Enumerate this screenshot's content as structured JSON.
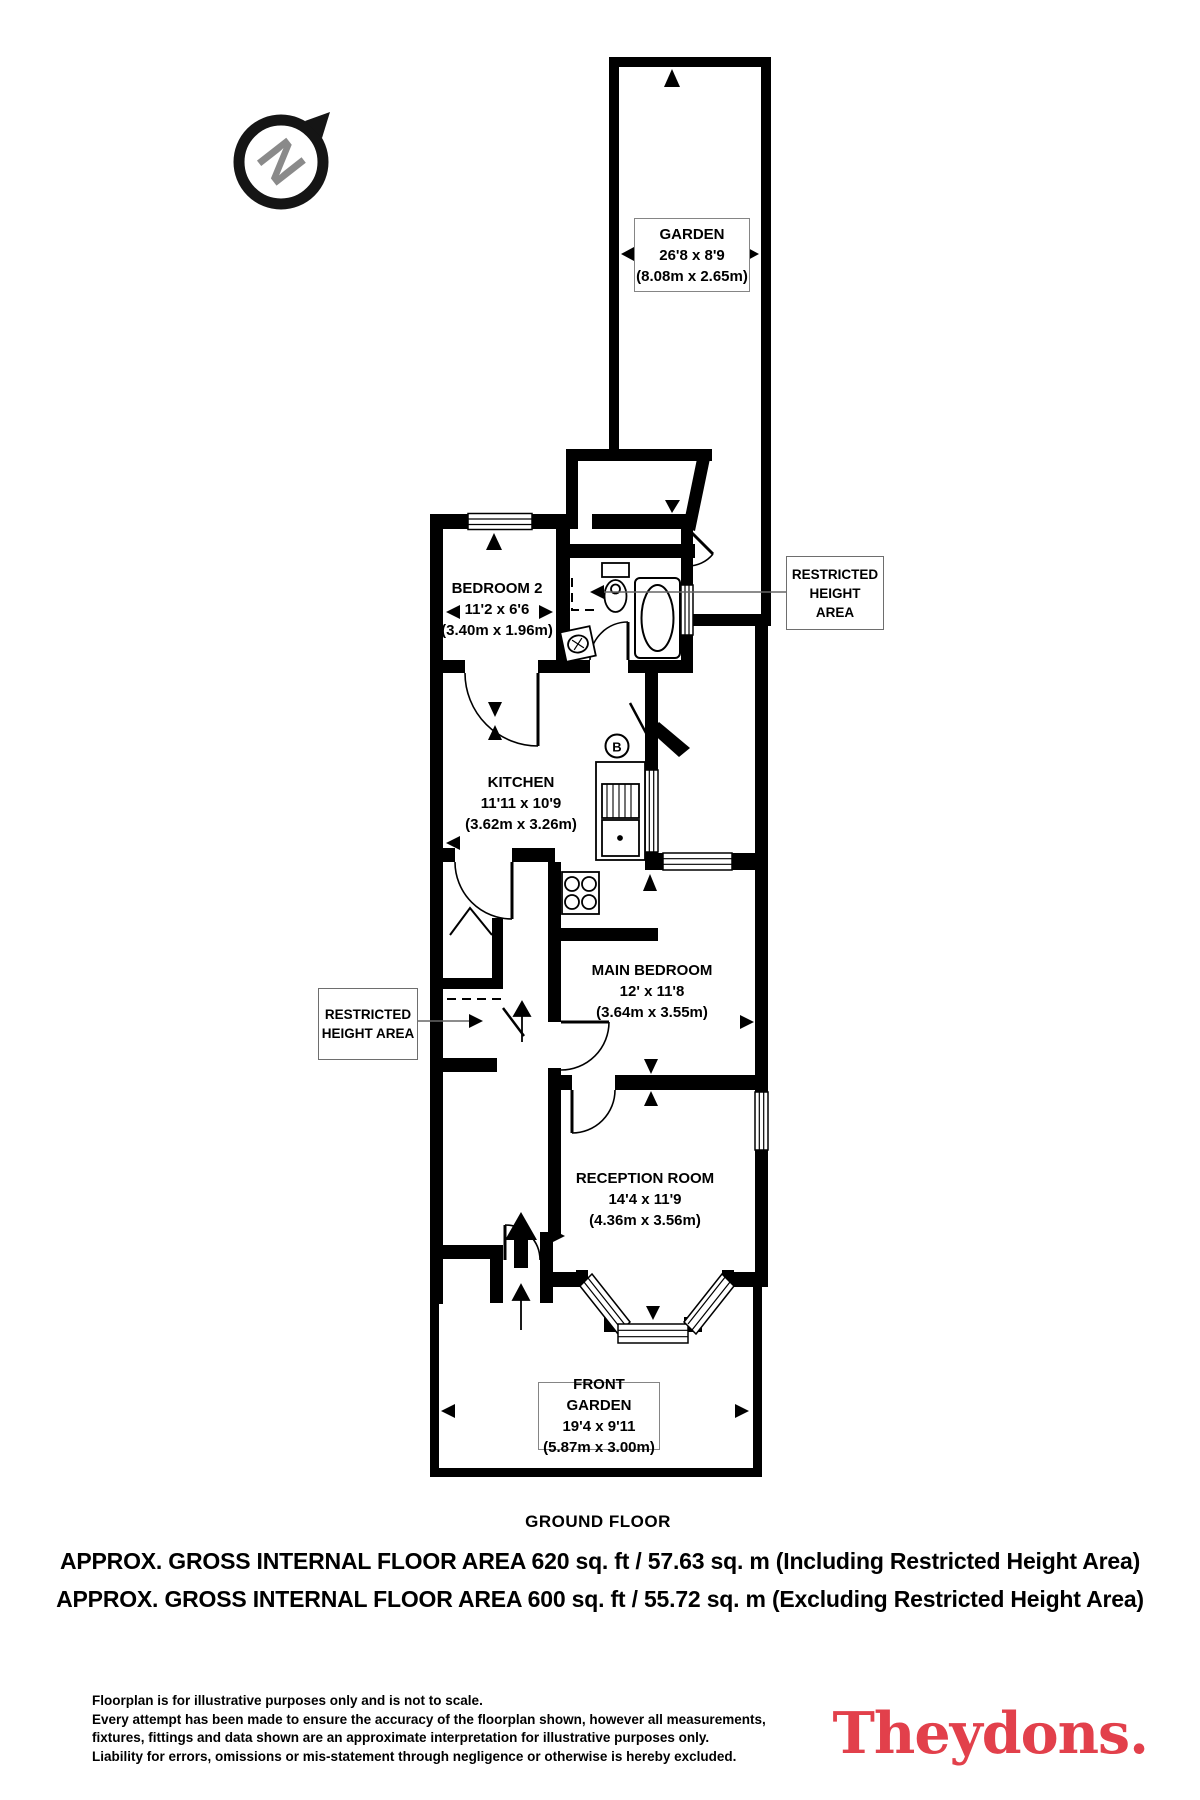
{
  "compass": {
    "letter": "N"
  },
  "plan": {
    "rooms": {
      "garden": {
        "name": "GARDEN",
        "dims": "26'8 x 8'9",
        "metric": "(8.08m x 2.65m)"
      },
      "bedroom2": {
        "name": "BEDROOM 2",
        "dims": "11'2 x 6'6",
        "metric": "(3.40m x 1.96m)"
      },
      "kitchen": {
        "name": "KITCHEN",
        "dims": "11'11 x 10'9",
        "metric": "(3.62m x 3.26m)"
      },
      "main_bedroom": {
        "name": "MAIN BEDROOM",
        "dims": "12' x 11'8",
        "metric": "(3.64m x 3.55m)"
      },
      "reception": {
        "name": "RECEPTION ROOM",
        "dims": "14'4 x 11'9",
        "metric": "(4.36m x 3.56m)"
      },
      "front_garden": {
        "name": "FRONT GARDEN",
        "dims": "19'4 x 9'11",
        "metric": "(5.87m x 3.00m)"
      }
    },
    "restricted_height_label": "RESTRICTED HEIGHT AREA",
    "boiler_letter": "B",
    "floor_title": "GROUND FLOOR"
  },
  "footer": {
    "area_line_1": "APPROX. GROSS INTERNAL FLOOR AREA 620 sq. ft / 57.63 sq. m (Including Restricted Height Area)",
    "area_line_2": "APPROX. GROSS INTERNAL FLOOR AREA 600 sq. ft / 55.72 sq. m (Excluding Restricted Height Area)",
    "disclaimer_lines": [
      "Floorplan is for illustrative purposes only and is not to scale.",
      "Every attempt has been made to ensure the accuracy of the floorplan shown, however all measurements,",
      "fixtures, fittings and data shown are an approximate interpretation for illustrative purposes only.",
      "Liability for errors, omissions or mis-statement through negligence or otherwise is hereby excluded."
    ],
    "brand_name": "Theydons.",
    "brand_color": "#e2404b"
  }
}
